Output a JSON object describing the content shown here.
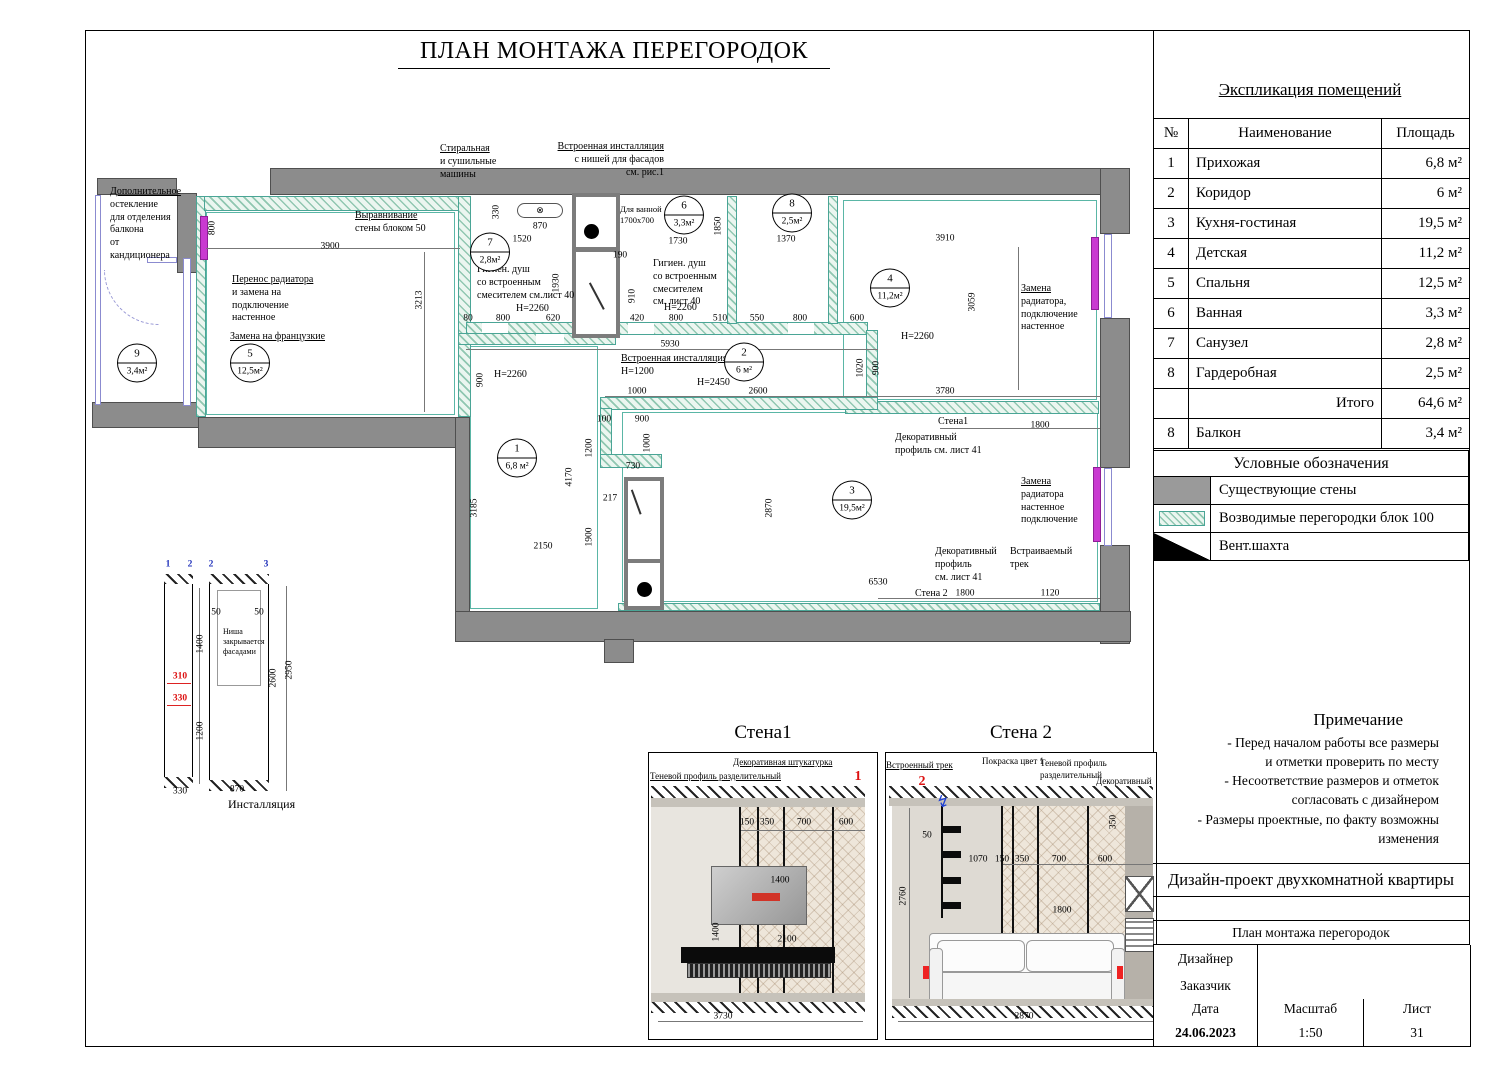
{
  "sheet": {
    "title": "ПЛАН МОНТАЖА ПЕРЕГОРОДОК"
  },
  "explication": {
    "title": "Экспликация помещений",
    "headers": {
      "num": "№",
      "name": "Наименование",
      "area": "Площадь"
    },
    "rows": [
      {
        "num": "1",
        "name": "Прихожая",
        "area": "6,8 м²"
      },
      {
        "num": "2",
        "name": "Коридор",
        "area": "6 м²"
      },
      {
        "num": "3",
        "name": "Кухня-гостиная",
        "area": "19,5 м²"
      },
      {
        "num": "4",
        "name": "Детская",
        "area": "11,2 м²"
      },
      {
        "num": "5",
        "name": "Спальня",
        "area": "12,5 м²"
      },
      {
        "num": "6",
        "name": "Ванная",
        "area": "3,3 м²"
      },
      {
        "num": "7",
        "name": "Санузел",
        "area": "2,8 м²"
      },
      {
        "num": "8",
        "name": "Гардеробная",
        "area": "2,5 м²"
      },
      {
        "num": "",
        "name": "Итого",
        "area": "64,6 м²",
        "total": true
      },
      {
        "num": "8",
        "name": "Балкон",
        "area": "3,4 м²"
      }
    ]
  },
  "legend": {
    "title": "Условные обозначения",
    "items": [
      {
        "type": "wall",
        "label": "Существующие стены"
      },
      {
        "type": "partition",
        "label": "Возводимые перегородки  блок 100"
      },
      {
        "type": "vent",
        "label": "Вент.шахта"
      }
    ]
  },
  "notes": {
    "title": "Примечание",
    "lines": [
      "- Перед началом работы все размеры",
      "и отметки проверить по месту",
      "- Несоответствие размеров и отметок",
      "согласовать  с дизайнером",
      "- Размеры проектные, по факту возможны",
      "изменения"
    ]
  },
  "titleblock": {
    "project": "Дизайн-проект двухкомнатной квартиры",
    "doc": "План монтажа перегородок",
    "designer_label": "Дизайнер",
    "client_label": "Заказчик",
    "date_label": "Дата",
    "scale_label": "Масштаб",
    "sheet_label": "Лист",
    "date": "24.06.2023",
    "scale": "1:50",
    "sheet": "31"
  },
  "elevations": {
    "wall1": "Стена1",
    "wall2": "Стена 2"
  },
  "colors": {
    "partition": "#4aa596",
    "wall": "#8c8c8c",
    "radiator": "#c93ad1",
    "red_dim": "#d11",
    "blue_mark": "#2233bb"
  },
  "plan": {
    "rooms": [
      {
        "n": "9",
        "a": "3,4м²",
        "x": 137,
        "y": 363
      },
      {
        "n": "5",
        "a": "12,5м²",
        "x": 250,
        "y": 363
      },
      {
        "n": "7",
        "a": "2,8м²",
        "x": 490,
        "y": 252
      },
      {
        "n": "6",
        "a": "3,3м²",
        "x": 684,
        "y": 215
      },
      {
        "n": "8",
        "a": "2,5м²",
        "x": 792,
        "y": 213
      },
      {
        "n": "4",
        "a": "11,2м²",
        "x": 890,
        "y": 288
      },
      {
        "n": "2",
        "a": "6 м²",
        "x": 744,
        "y": 362
      },
      {
        "n": "1",
        "a": "6,8 м²",
        "x": 517,
        "y": 458
      },
      {
        "n": "3",
        "a": "19,5м²",
        "x": 852,
        "y": 500
      }
    ],
    "annotations": [
      {
        "t": "Стиральная\nи сушильные\nмашины",
        "x": 440,
        "y": 143,
        "w": 64,
        "u": 1
      },
      {
        "t": "Встроенная инсталляция\nс нишей для фасадов\nсм. рис.1",
        "x": 548,
        "y": 141,
        "w": 116,
        "u": 1,
        "a": "right"
      },
      {
        "t": "Дополнительное\nостекление\nдля отделения\nбалкона\nот кандиционера",
        "x": 110,
        "y": 186,
        "w": 70,
        "u": 1
      },
      {
        "t": "Выравнивание\nстены блоком 50",
        "x": 355,
        "y": 210,
        "w": 84,
        "u": 1
      },
      {
        "t": "Перенос радиатора\nи замена на\nподключение\nнастенное",
        "x": 232,
        "y": 274,
        "w": 88,
        "u": 1
      },
      {
        "t": "Замена на французкие",
        "x": 230,
        "y": 331,
        "w": 115,
        "u": 1
      },
      {
        "t": "Гигиен. душ\nсо встроенным\nсмесителем см.лист 40",
        "x": 477,
        "y": 264,
        "w": 102
      },
      {
        "t": "Н=2260",
        "x": 516,
        "y": 303,
        "w": 46
      },
      {
        "t": "Для ванной\n1700x700",
        "x": 620,
        "y": 204,
        "w": 52,
        "size": 8.5
      },
      {
        "t": "Гигиен. душ\nсо встроенным\nсмесителем\nсм. лист 40",
        "x": 653,
        "y": 258,
        "w": 72
      },
      {
        "t": "Н=2260",
        "x": 664,
        "y": 302,
        "w": 46
      },
      {
        "t": "Встроенная инсталляция\nН=1200",
        "x": 621,
        "y": 353,
        "w": 118,
        "u": 1
      },
      {
        "t": "Н=2450",
        "x": 697,
        "y": 377,
        "w": 46
      },
      {
        "t": "Н=2260",
        "x": 494,
        "y": 369,
        "w": 46
      },
      {
        "t": "Н=2260",
        "x": 901,
        "y": 331,
        "w": 46
      },
      {
        "t": "Замена\nрадиатора,\nподключение\nнастенное",
        "x": 1021,
        "y": 283,
        "w": 62,
        "u": 1
      },
      {
        "t": "Стена1",
        "x": 938,
        "y": 416,
        "w": 42
      },
      {
        "t": "Декоративный\nпрофиль см. лист 41",
        "x": 895,
        "y": 432,
        "w": 98
      },
      {
        "t": "Замена\nрадиатора\nнастенное\nподключение",
        "x": 1021,
        "y": 476,
        "w": 62,
        "u": 1
      },
      {
        "t": "Декоративный\nпрофиль\nсм. лист 41",
        "x": 935,
        "y": 546,
        "w": 62
      },
      {
        "t": "Встраиваемый\nтрек",
        "x": 1010,
        "y": 546,
        "w": 68
      },
      {
        "t": "Стена 2",
        "x": 915,
        "y": 588,
        "w": 42
      },
      {
        "t": "Ниша\nзакрывается\nфасадами",
        "x": 223,
        "y": 627,
        "w": 46,
        "size": 8
      },
      {
        "t": "Инсталляция",
        "x": 228,
        "y": 797,
        "w": 92,
        "size": 12
      },
      {
        "t": "Декоративная штукатурка",
        "x": 733,
        "y": 757,
        "w": 124,
        "u": 1,
        "size": 9
      },
      {
        "t": "Теневой профиль разделительный",
        "x": 650,
        "y": 771,
        "w": 152,
        "u": 1,
        "size": 9
      },
      {
        "t": "Встроенный трек",
        "x": 886,
        "y": 760,
        "w": 80,
        "u": 1,
        "size": 9
      },
      {
        "t": "Покраска цвет 1",
        "x": 982,
        "y": 756,
        "w": 76,
        "size": 9
      },
      {
        "t": "Теневой профиль разделительный",
        "x": 1040,
        "y": 758,
        "w": 112,
        "size": 9
      },
      {
        "t": "Декоративный",
        "x": 1096,
        "y": 776,
        "w": 58,
        "size": 9
      }
    ],
    "dims": [
      {
        "t": "800",
        "x": 213,
        "y": 228,
        "v": 1
      },
      {
        "t": "3900",
        "x": 330,
        "y": 247
      },
      {
        "t": "3213",
        "x": 420,
        "y": 300,
        "v": 1
      },
      {
        "t": "650",
        "x": 495,
        "y": 248
      },
      {
        "t": "330",
        "x": 497,
        "y": 212,
        "v": 1
      },
      {
        "t": "870",
        "x": 540,
        "y": 227
      },
      {
        "t": "1520",
        "x": 522,
        "y": 240
      },
      {
        "t": "1930",
        "x": 557,
        "y": 283,
        "v": 1
      },
      {
        "t": "80",
        "x": 468,
        "y": 319
      },
      {
        "t": "800",
        "x": 503,
        "y": 319
      },
      {
        "t": "620",
        "x": 553,
        "y": 319
      },
      {
        "t": "190",
        "x": 620,
        "y": 256
      },
      {
        "t": "910",
        "x": 633,
        "y": 296,
        "v": 1
      },
      {
        "t": "420",
        "x": 637,
        "y": 319
      },
      {
        "t": "800",
        "x": 676,
        "y": 319
      },
      {
        "t": "510",
        "x": 720,
        "y": 319
      },
      {
        "t": "5930",
        "x": 670,
        "y": 345
      },
      {
        "t": "1730",
        "x": 678,
        "y": 242
      },
      {
        "t": "1850",
        "x": 719,
        "y": 226,
        "v": 1
      },
      {
        "t": "1370",
        "x": 786,
        "y": 240
      },
      {
        "t": "550",
        "x": 757,
        "y": 319
      },
      {
        "t": "800",
        "x": 800,
        "y": 319
      },
      {
        "t": "600",
        "x": 857,
        "y": 319
      },
      {
        "t": "3910",
        "x": 945,
        "y": 239
      },
      {
        "t": "3059",
        "x": 973,
        "y": 302,
        "v": 1
      },
      {
        "t": "1020",
        "x": 861,
        "y": 368,
        "v": 1
      },
      {
        "t": "900",
        "x": 877,
        "y": 368,
        "v": 1
      },
      {
        "t": "2600",
        "x": 758,
        "y": 392
      },
      {
        "t": "3780",
        "x": 945,
        "y": 392
      },
      {
        "t": "1000",
        "x": 637,
        "y": 392
      },
      {
        "t": "900",
        "x": 481,
        "y": 380,
        "v": 1
      },
      {
        "t": "100",
        "x": 604,
        "y": 420
      },
      {
        "t": "900",
        "x": 642,
        "y": 420
      },
      {
        "t": "1200",
        "x": 590,
        "y": 448,
        "v": 1
      },
      {
        "t": "1000",
        "x": 648,
        "y": 443,
        "v": 1
      },
      {
        "t": "730",
        "x": 633,
        "y": 467
      },
      {
        "t": "217",
        "x": 610,
        "y": 499
      },
      {
        "t": "1900",
        "x": 590,
        "y": 537,
        "v": 1
      },
      {
        "t": "4170",
        "x": 570,
        "y": 477,
        "v": 1
      },
      {
        "t": "3185",
        "x": 475,
        "y": 508,
        "v": 1
      },
      {
        "t": "2150",
        "x": 543,
        "y": 547
      },
      {
        "t": "2870",
        "x": 770,
        "y": 508,
        "v": 1
      },
      {
        "t": "6530",
        "x": 878,
        "y": 583
      },
      {
        "t": "1800",
        "x": 965,
        "y": 594
      },
      {
        "t": "1120",
        "x": 1050,
        "y": 594
      },
      {
        "t": "1800",
        "x": 1040,
        "y": 426
      },
      {
        "t": "310",
        "x": 180,
        "y": 677,
        "c": "red"
      },
      {
        "t": "330",
        "x": 180,
        "y": 699,
        "c": "red"
      },
      {
        "t": "1400",
        "x": 201,
        "y": 644,
        "v": 1
      },
      {
        "t": "1200",
        "x": 201,
        "y": 731,
        "v": 1
      },
      {
        "t": "50",
        "x": 216,
        "y": 613
      },
      {
        "t": "50",
        "x": 259,
        "y": 613
      },
      {
        "t": "2600",
        "x": 274,
        "y": 678,
        "v": 1
      },
      {
        "t": "2950",
        "x": 290,
        "y": 670,
        "v": 1
      },
      {
        "t": "330",
        "x": 180,
        "y": 792
      },
      {
        "t": "870",
        "x": 237,
        "y": 790
      },
      {
        "t": "1",
        "x": 168,
        "y": 565,
        "c": "blue"
      },
      {
        "t": "2",
        "x": 190,
        "y": 565,
        "c": "blue"
      },
      {
        "t": "2",
        "x": 211,
        "y": 565,
        "c": "blue"
      },
      {
        "t": "3",
        "x": 266,
        "y": 565,
        "c": "blue"
      },
      {
        "t": "150",
        "x": 747,
        "y": 823
      },
      {
        "t": "350",
        "x": 767,
        "y": 823
      },
      {
        "t": "700",
        "x": 804,
        "y": 823
      },
      {
        "t": "600",
        "x": 846,
        "y": 823
      },
      {
        "t": "1400",
        "x": 780,
        "y": 881
      },
      {
        "t": "1400",
        "x": 717,
        "y": 932,
        "v": 1
      },
      {
        "t": "2100",
        "x": 787,
        "y": 940
      },
      {
        "t": "3730",
        "x": 723,
        "y": 1017
      },
      {
        "t": "1",
        "x": 858,
        "y": 777,
        "c": "red",
        "s": 14
      },
      {
        "t": "50",
        "x": 927,
        "y": 836
      },
      {
        "t": "2760",
        "x": 904,
        "y": 896,
        "v": 1
      },
      {
        "t": "1070",
        "x": 978,
        "y": 860
      },
      {
        "t": "150",
        "x": 1002,
        "y": 860
      },
      {
        "t": "350",
        "x": 1022,
        "y": 860
      },
      {
        "t": "700",
        "x": 1059,
        "y": 860
      },
      {
        "t": "600",
        "x": 1105,
        "y": 860
      },
      {
        "t": "350",
        "x": 1114,
        "y": 822,
        "v": 1
      },
      {
        "t": "1800",
        "x": 1062,
        "y": 911
      },
      {
        "t": "2870",
        "x": 1024,
        "y": 1017
      },
      {
        "t": "2",
        "x": 922,
        "y": 782,
        "c": "red",
        "s": 14
      }
    ]
  }
}
